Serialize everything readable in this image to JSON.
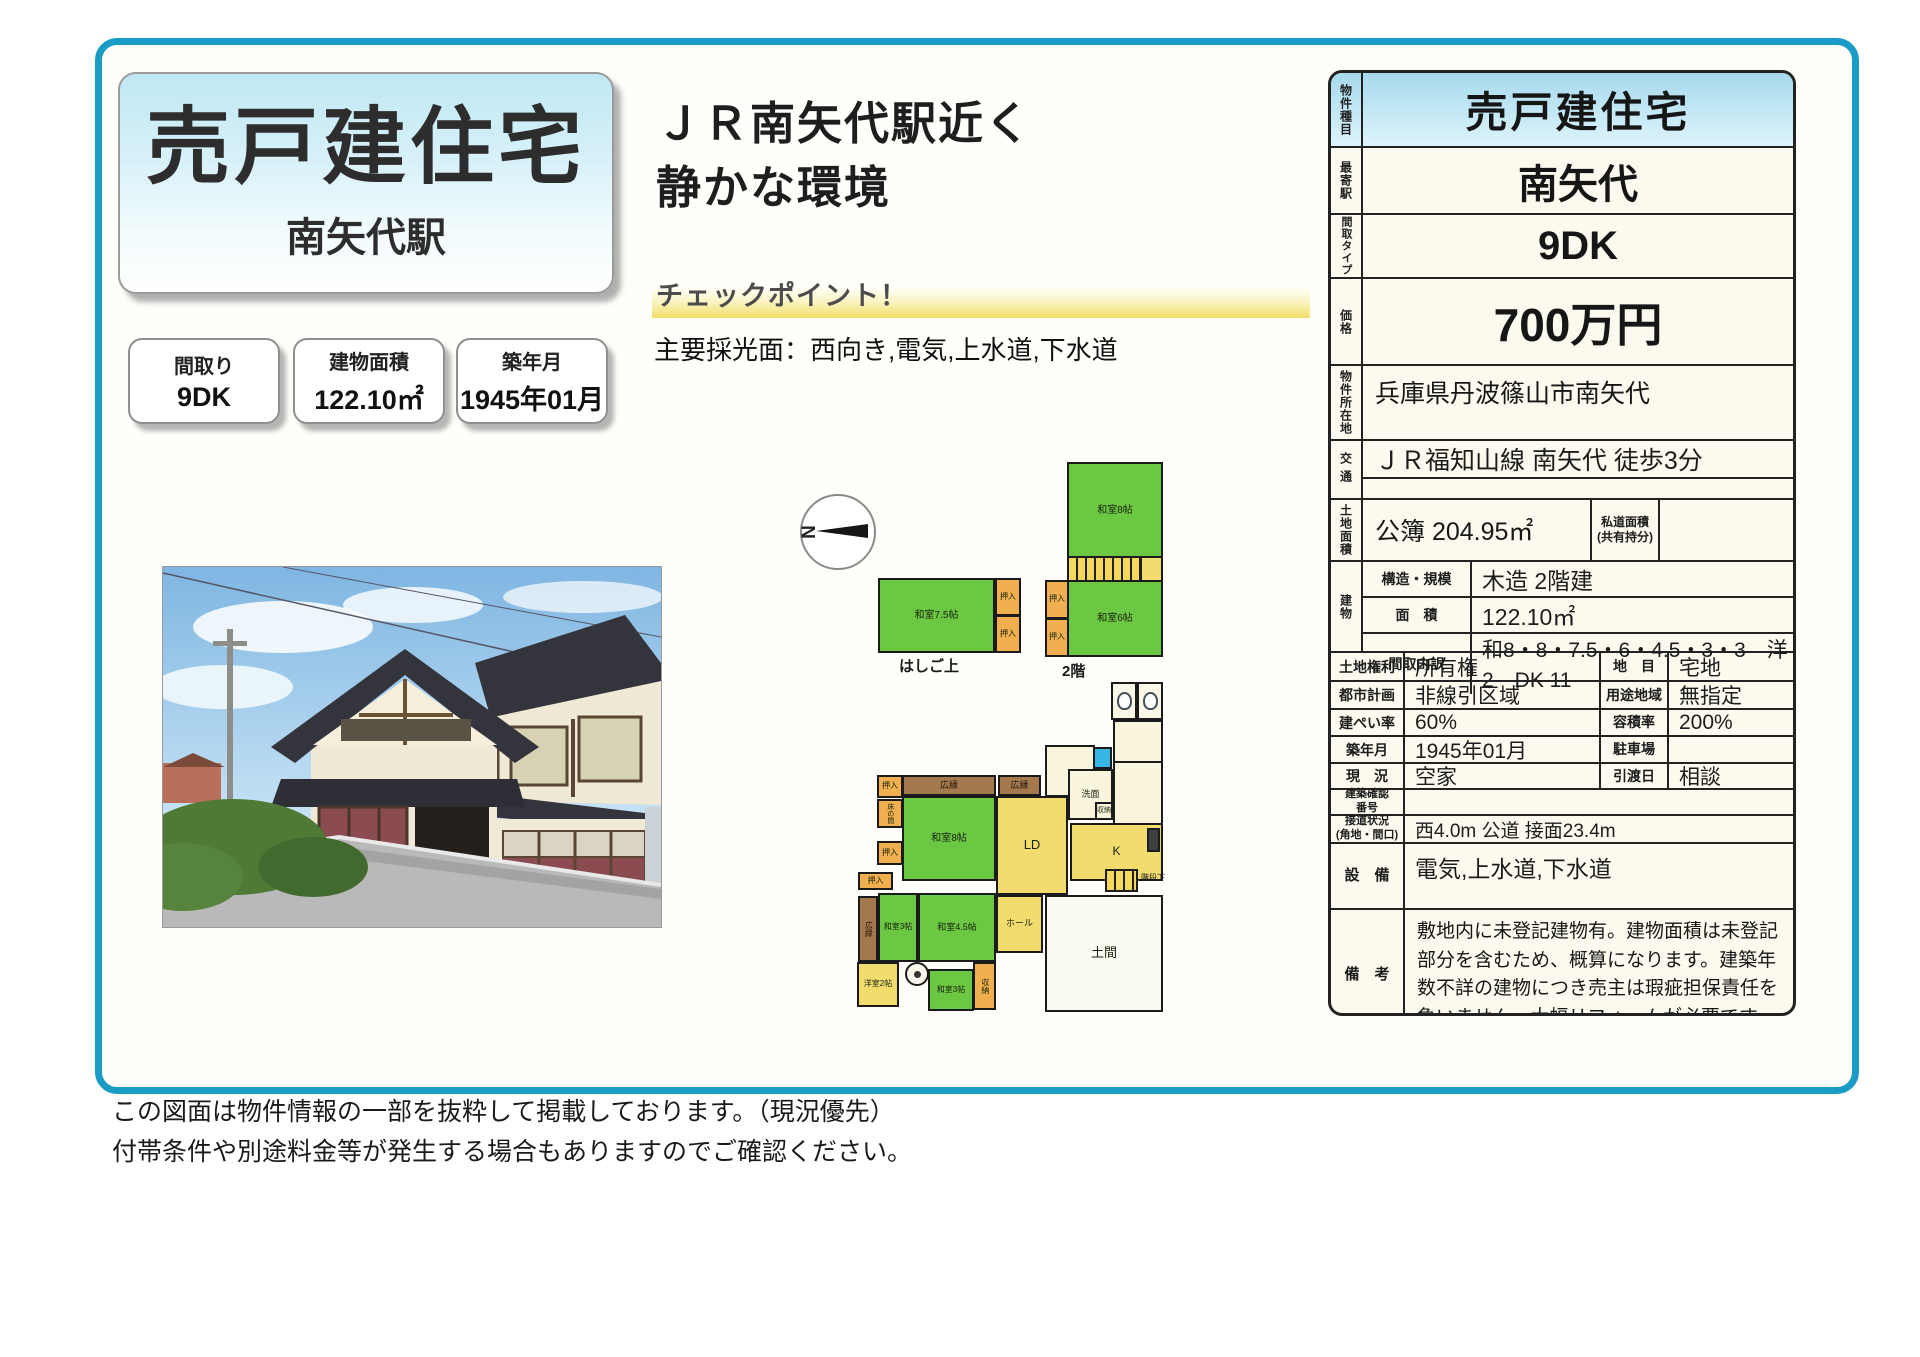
{
  "page": {
    "title_box": {
      "title": "売戸建住宅",
      "subtitle": "南矢代駅"
    },
    "catchcopy": {
      "line1": "ＪＲ南矢代駅近く",
      "line2": "静かな環境"
    },
    "checkpoint": {
      "label": "チェックポイント！",
      "detail": "主要採光面：西向き,電気,上水道,下水道"
    },
    "spec_boxes": [
      {
        "label": "間取り",
        "value": "9DK"
      },
      {
        "label": "建物面積",
        "value": "122.10㎡"
      },
      {
        "label": "築年月",
        "value": "1945年01月"
      }
    ],
    "disclaimer": [
      "この図面は物件情報の一部を抜粋して掲載しております。（現況優先）",
      "付帯条件や別途料金等が発生する場合もありますのでご確認ください。"
    ]
  },
  "info_table": {
    "property_type": {
      "label": "物件種目",
      "value": "売戸建住宅"
    },
    "nearest_station": {
      "label": "最寄駅",
      "value": "南矢代"
    },
    "layout_type": {
      "label": "間取タイプ",
      "value": "9DK"
    },
    "price": {
      "label": "価格",
      "value": "700万円"
    },
    "address": {
      "label": "物件所在地",
      "value": "兵庫県丹波篠山市南矢代"
    },
    "access": {
      "label": "交通",
      "value": "ＪＲ福知山線 南矢代 徒歩3分"
    },
    "land": {
      "label": "土地面積",
      "value": "公簿 204.95㎡",
      "sub_label": "私道面積\n(共有持分)",
      "sub_value": ""
    },
    "building": {
      "label": "建物",
      "rows": [
        {
          "label": "構造・規模",
          "value": "木造 2階建"
        },
        {
          "label": "面　積",
          "value": "122.10㎡"
        },
        {
          "label": "間取内訳",
          "value": "和8・8・7.5・6・4.5・3・3　洋2　DK 11"
        }
      ]
    },
    "pairs": [
      [
        {
          "label": "土地権利",
          "value": "所有権"
        },
        {
          "label": "地　目",
          "value": "宅地"
        }
      ],
      [
        {
          "label": "都市計画",
          "value": "非線引区域"
        },
        {
          "label": "用途地域",
          "value": "無指定"
        }
      ],
      [
        {
          "label": "建ぺい率",
          "value": "60%"
        },
        {
          "label": "容積率",
          "value": "200%"
        }
      ],
      [
        {
          "label": "築年月",
          "value": "1945年01月"
        },
        {
          "label": "駐車場",
          "value": ""
        }
      ],
      [
        {
          "label": "現　況",
          "value": "空家"
        },
        {
          "label": "引渡日",
          "value": "相談"
        }
      ]
    ],
    "confirmation": {
      "label": "建築確認\n番号",
      "value": ""
    },
    "road": {
      "label": "接道状況\n(角地・間口)",
      "value": "西4.0m 公道 接面23.4m"
    },
    "facilities": {
      "label": "設　備",
      "value": "電気,上水道,下水道"
    },
    "remarks": {
      "label": "備　考",
      "value": "敷地内に未登記建物有。建物面積は未登記部分を含むため、概算になります。建築年数不詳の建物につき売主は瑕疵担保責任を負いません。大幅リフォームが必要です。"
    }
  },
  "floorplan": {
    "compass_label": "N",
    "captions": [
      {
        "text": "はしご上",
        "x": 899,
        "y": 655,
        "fs": 15
      },
      {
        "text": "2階",
        "x": 1062,
        "y": 660,
        "fs": 15
      }
    ],
    "rooms": [
      {
        "l": "和室7.5帖",
        "x": 878,
        "y": 578,
        "w": 117,
        "h": 75,
        "t": "tatami"
      },
      {
        "l": "押入",
        "x": 995,
        "y": 578,
        "w": 26,
        "h": 38,
        "t": "closet",
        "fs": 8
      },
      {
        "l": "押入",
        "x": 995,
        "y": 615,
        "w": 26,
        "h": 38,
        "t": "closet",
        "fs": 8
      },
      {
        "l": "和室8帖",
        "x": 1067,
        "y": 462,
        "w": 96,
        "h": 96,
        "t": "tatami"
      },
      {
        "l": "",
        "x": 1140,
        "y": 556,
        "w": 23,
        "h": 26,
        "t": "hall"
      },
      {
        "l": "",
        "x": 1067,
        "y": 556,
        "w": 75,
        "h": 26,
        "t": "stairs"
      },
      {
        "l": "押入",
        "x": 1045,
        "y": 580,
        "w": 24,
        "h": 39,
        "t": "closet",
        "fs": 8
      },
      {
        "l": "押入",
        "x": 1045,
        "y": 618,
        "w": 24,
        "h": 39,
        "t": "closet",
        "fs": 8
      },
      {
        "l": "和室6帖",
        "x": 1067,
        "y": 580,
        "w": 96,
        "h": 77,
        "t": "tatami"
      },
      {
        "l": "",
        "x": 1045,
        "y": 745,
        "w": 50,
        "h": 52,
        "t": "svc"
      },
      {
        "l": "",
        "x": 1113,
        "y": 761,
        "w": 50,
        "h": 64,
        "t": "svc"
      },
      {
        "l": "",
        "x": 1111,
        "y": 682,
        "w": 26,
        "h": 38,
        "t": "wc"
      },
      {
        "l": "",
        "x": 1137,
        "y": 682,
        "w": 26,
        "h": 38,
        "t": "wc"
      },
      {
        "l": "",
        "x": 1113,
        "y": 720,
        "w": 50,
        "h": 43,
        "t": "svc"
      },
      {
        "l": "",
        "x": 1093,
        "y": 747,
        "w": 19,
        "h": 22,
        "t": "bath"
      },
      {
        "l": "洗面",
        "x": 1068,
        "y": 769,
        "w": 45,
        "h": 51,
        "t": "svc",
        "fs": 9
      },
      {
        "l": "収納",
        "x": 1095,
        "y": 802,
        "w": 18,
        "h": 18,
        "t": "svc",
        "fs": 7
      },
      {
        "l": "押入",
        "x": 877,
        "y": 775,
        "w": 26,
        "h": 23,
        "t": "closet",
        "fs": 8
      },
      {
        "l": "広縁",
        "x": 902,
        "y": 775,
        "w": 94,
        "h": 21,
        "t": "engawa",
        "fs": 9
      },
      {
        "l": "広縁",
        "x": 998,
        "y": 775,
        "w": 43,
        "h": 21,
        "t": "engawa",
        "fs": 9
      },
      {
        "l": "床の間",
        "x": 877,
        "y": 799,
        "w": 26,
        "h": 29,
        "t": "closet",
        "v": 1,
        "fs": 7
      },
      {
        "l": "押入",
        "x": 877,
        "y": 841,
        "w": 26,
        "h": 24,
        "t": "closet",
        "fs": 8
      },
      {
        "l": "和室8帖",
        "x": 902,
        "y": 796,
        "w": 94,
        "h": 85,
        "t": "tatami"
      },
      {
        "l": "LD",
        "x": 996,
        "y": 796,
        "w": 72,
        "h": 99,
        "t": "hall",
        "fs": 13
      },
      {
        "l": "K",
        "x": 1070,
        "y": 823,
        "w": 93,
        "h": 58,
        "t": "hall",
        "fs": 12
      },
      {
        "l": "",
        "x": 1147,
        "y": 828,
        "w": 13,
        "h": 24,
        "t": "dark"
      },
      {
        "l": "",
        "x": 1105,
        "y": 869,
        "w": 33,
        "h": 23,
        "t": "stairs"
      },
      {
        "l": "階段下",
        "x": 1139,
        "y": 872,
        "w": 28,
        "h": 12,
        "t": "label",
        "fs": 8
      },
      {
        "l": "押入",
        "x": 858,
        "y": 872,
        "w": 35,
        "h": 18,
        "t": "closet",
        "fs": 8
      },
      {
        "l": "広縁",
        "x": 858,
        "y": 896,
        "w": 20,
        "h": 66,
        "t": "engawa",
        "v": 1,
        "fs": 8
      },
      {
        "l": "和室3帖",
        "x": 878,
        "y": 893,
        "w": 40,
        "h": 69,
        "t": "tatami",
        "fs": 8
      },
      {
        "l": "和室4.5帖",
        "x": 918,
        "y": 893,
        "w": 78,
        "h": 69,
        "t": "tatami",
        "fs": 9
      },
      {
        "l": "ホール",
        "x": 996,
        "y": 895,
        "w": 47,
        "h": 58,
        "t": "hall",
        "fs": 9
      },
      {
        "l": "土間",
        "x": 1045,
        "y": 895,
        "w": 118,
        "h": 117,
        "t": "doma",
        "fs": 13
      },
      {
        "l": "洋室2帖",
        "x": 857,
        "y": 962,
        "w": 42,
        "h": 45,
        "t": "hall",
        "fs": 8
      },
      {
        "l": "",
        "x": 905,
        "y": 962,
        "w": 24,
        "h": 24,
        "t": "hearth"
      },
      {
        "l": "和室3帖",
        "x": 928,
        "y": 969,
        "w": 46,
        "h": 42,
        "t": "tatami",
        "fs": 8
      },
      {
        "l": "収納",
        "x": 973,
        "y": 962,
        "w": 23,
        "h": 48,
        "t": "closet",
        "v": 1,
        "fs": 8
      }
    ]
  }
}
